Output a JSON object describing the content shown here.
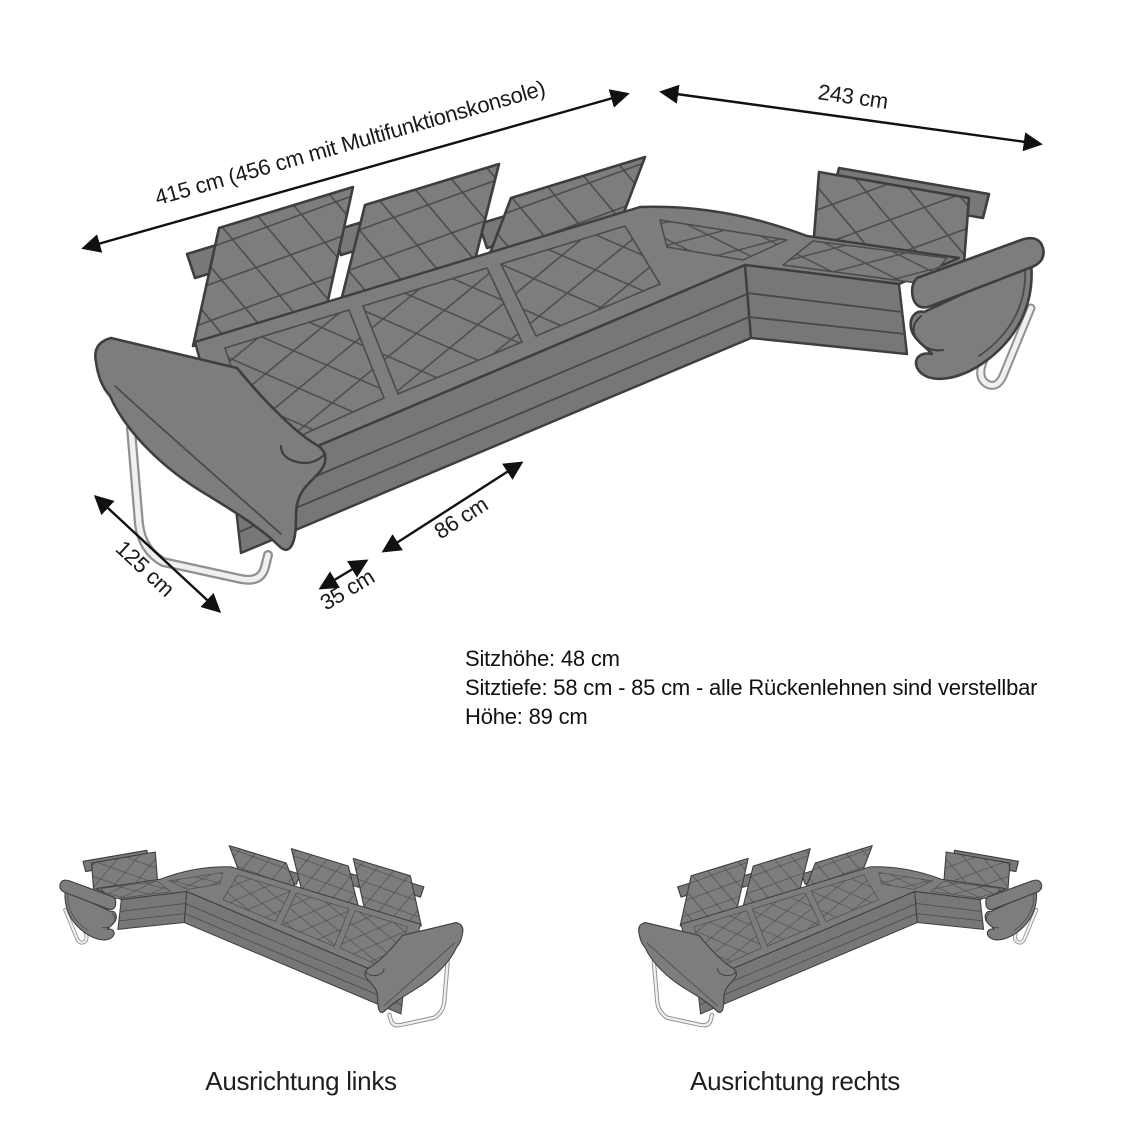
{
  "diagram": {
    "title": "Ecksofa Abmessungen",
    "product": "L-Form Ecksofa mit verstellbaren Rückenlehnen",
    "dimensions": {
      "total_width_label": "415 cm (456 cm mit Multifunktionskonsole)",
      "side_length_label": "243 cm",
      "end_depth_label": "125 cm",
      "seat_width_label": "86 cm",
      "armrest_width_label": "35 cm"
    },
    "specs": {
      "seat_height": "Sitzhöhe: 48 cm",
      "seat_depth": "Sitztiefe: 58 cm - 85 cm - alle Rückenlehnen sind verstellbar",
      "height": "Höhe: 89 cm"
    },
    "orientations": {
      "left_label": "Ausrichtung links",
      "right_label": "Ausrichtung rechts"
    },
    "colors": {
      "sofa_body": "#7d7d7d",
      "sofa_front_face": "#777777",
      "sofa_outline": "#3e3e3e",
      "quilt_line": "#4b4b4b",
      "leg_chrome_light": "#f1f0ee",
      "leg_chrome_edge": "#909090",
      "dimension_line": "#111111",
      "background": "#ffffff"
    }
  }
}
